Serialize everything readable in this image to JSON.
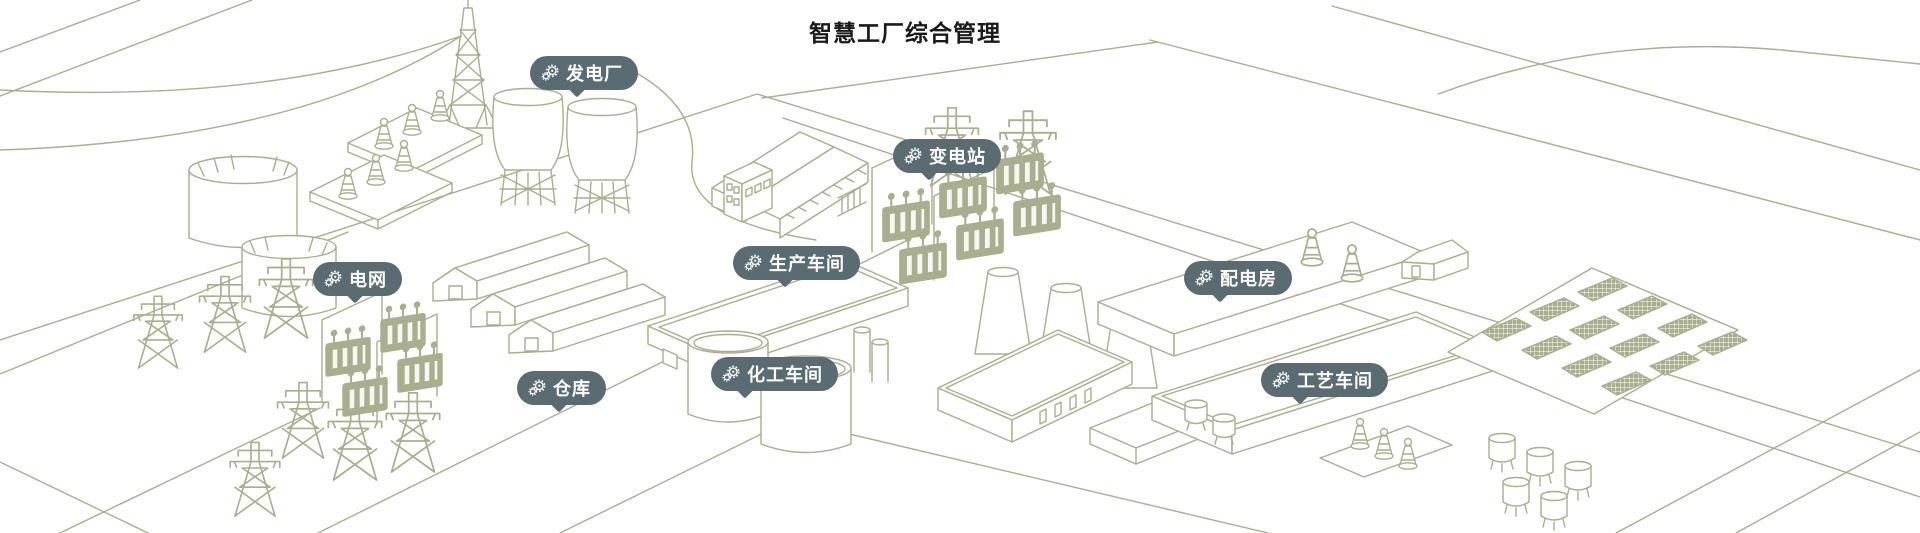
{
  "app": {
    "title": "智慧工厂综合管理"
  },
  "markers": [
    {
      "id": "power-plant",
      "label": "发电厂",
      "icon": "gears-icon"
    },
    {
      "id": "substation",
      "label": "变电站",
      "icon": "gears-icon"
    },
    {
      "id": "power-grid",
      "label": "电网",
      "icon": "gears-icon"
    },
    {
      "id": "production-workshop",
      "label": "生产车间",
      "icon": "gears-icon"
    },
    {
      "id": "distribution-room",
      "label": "配电房",
      "icon": "gears-icon"
    },
    {
      "id": "warehouse",
      "label": "仓库",
      "icon": "gears-icon"
    },
    {
      "id": "chemical-workshop",
      "label": "化工车间",
      "icon": "gears-icon"
    },
    {
      "id": "process-workshop",
      "label": "工艺车间",
      "icon": "gears-icon"
    }
  ],
  "icons": {
    "gears-icon": "⚙"
  },
  "theme": {
    "badge_background": "#5b6b72",
    "badge_text_color": "#ffffff",
    "illustration_line_color": "#a9ae8e",
    "canvas_background": "#ffffff",
    "title_color": "#1a1a1a"
  },
  "scene_structures": [
    "transmission-towers",
    "cooling-towers",
    "insulator-platforms",
    "storage-tanks",
    "power-grid-transformers",
    "warehouse-sheds",
    "production-factory",
    "flat-workshop",
    "substation-transformers",
    "chimney-plant",
    "distribution-hall",
    "process-hall",
    "solar-farm",
    "chemical-tanks",
    "small-tanks",
    "roads"
  ]
}
